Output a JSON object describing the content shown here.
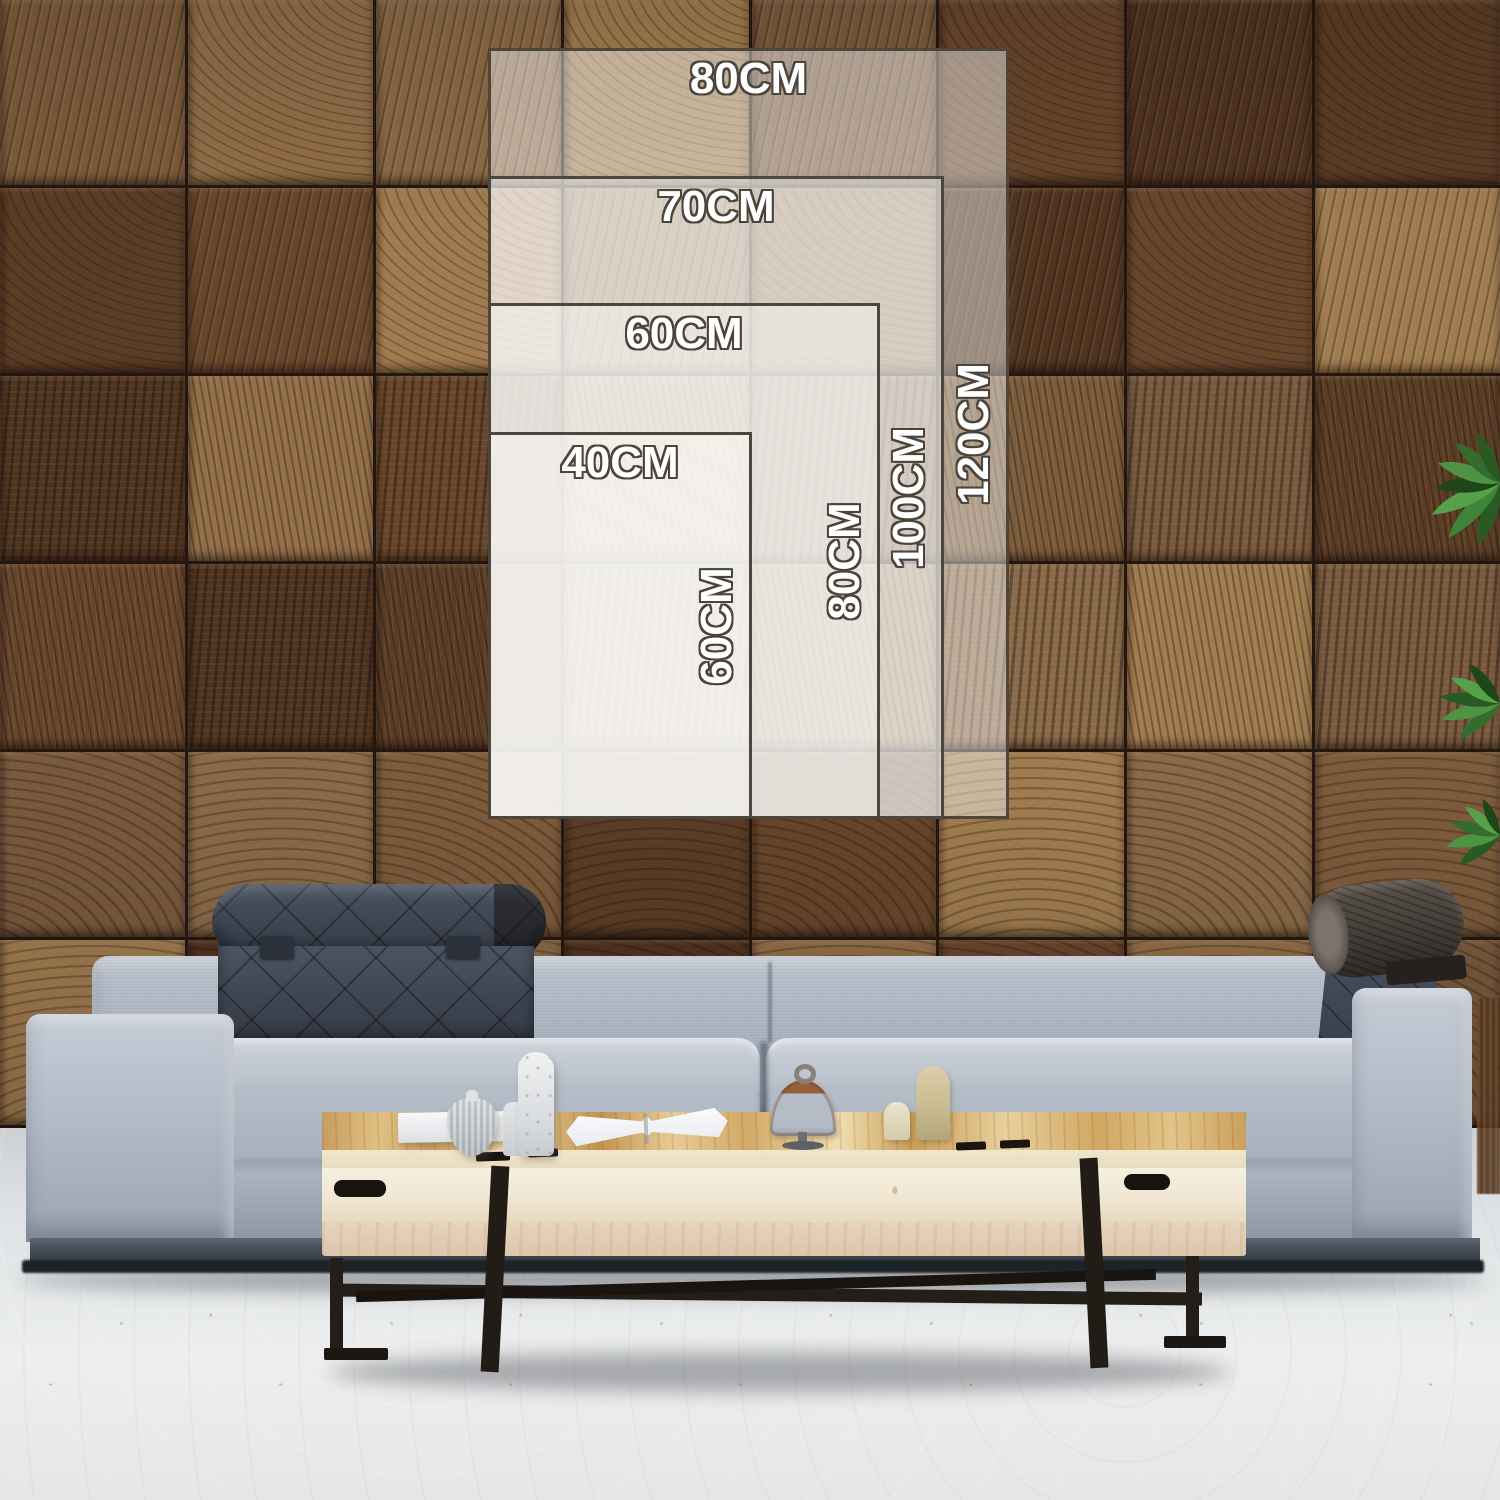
{
  "size_guide": {
    "unit": "CM",
    "sizes": [
      {
        "width_label": "80CM",
        "height_label": "120CM"
      },
      {
        "width_label": "70CM",
        "height_label": "100CM"
      },
      {
        "width_label": "60CM",
        "height_label": "80CM"
      },
      {
        "width_label": "40CM",
        "height_label": "60CM"
      }
    ],
    "label_color": "#ffffff",
    "label_outline_color": "#4a443b",
    "rect_border_color": "#4d463c",
    "rect_fill": "rgba(252,252,251,0.45)"
  },
  "scene": {
    "wall_palette": [
      "#7d5c3c",
      "#68462c",
      "#8a6a48",
      "#5b3d26",
      "#7a5a3e",
      "#936f4a",
      "#4f3420",
      "#a07c50"
    ],
    "wall_rows": 6,
    "wall_cols": 8,
    "sofa_fabric_color": "#aeb6c2",
    "headrest_color": "#3d4450",
    "bolster_color": "#453e38",
    "table_wood_color": "#d9b77e",
    "table_front_color": "#f1e9d8",
    "table_leg_color": "#241e18",
    "floor_color": "#dfe2e4",
    "plant_leaf_color": "#3f8438"
  }
}
